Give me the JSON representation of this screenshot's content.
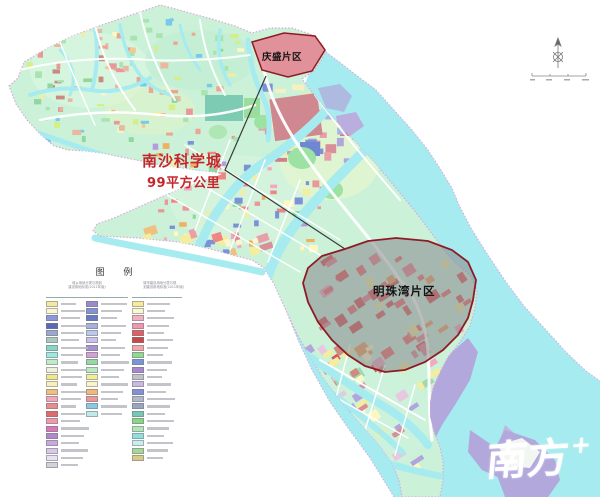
{
  "map": {
    "science_city": {
      "name": "南沙科学城",
      "area": "99平方公里"
    },
    "regions": {
      "qingsheng": {
        "name": "庆盛片区"
      },
      "mingzhuwan": {
        "name": "明珠湾片区"
      }
    },
    "watermark": {
      "text": "南方",
      "plus": "+"
    }
  },
  "legend": {
    "title": "图 例",
    "group_headers": [
      {
        "line1": "城乡用地分类与规划",
        "line2": "建设用地标准(2011年版)"
      },
      {
        "line1": "城市建设用地分类与规",
        "line2": "划建设用地标准(2011年版)"
      }
    ],
    "columns": [
      {
        "swatches": [
          "#f2e9a4",
          "#fbf6d2",
          "#8b98d8",
          "#5a68b8",
          "#9aa8cc",
          "#aac8bc",
          "#84d6c6",
          "#9fe8e0",
          "#bfecc6",
          "#eef0de",
          "#efe78e",
          "#f8f0bc",
          "#eec07e",
          "#f2a8ba",
          "#e88c8c",
          "#df6a6a",
          "#ef99a9",
          "#d878b8",
          "#b189ca",
          "#c9a9d9",
          "#d9c9e9",
          "#e9e1f1",
          "#d2d2da"
        ]
      },
      {
        "swatches": [
          "#9a8aca",
          "#8292d2",
          "#6a7ac2",
          "#a2b2da",
          "#bac9e9",
          "#c9c1e9",
          "#a991d1",
          "#d1a1d1",
          "#92d9a2",
          "#bae9c2",
          "#f1ed9a",
          "#f9f5c9",
          "#f1b979",
          "#e99999",
          "#8ac9e1",
          "#c1e9e9"
        ]
      },
      {
        "swatches": [
          "#f4ec9c",
          "#fcf7cf",
          "#f1b1c1",
          "#ef97af",
          "#df6060",
          "#c74848",
          "#efa7a7",
          "#91d991",
          "#7997d7",
          "#a787cf",
          "#c1c1c9",
          "#c9b9df",
          "#8191d1",
          "#b1b9c9",
          "#97a7bf",
          "#77c7b7",
          "#87d787",
          "#afe7b7",
          "#8fdfdf",
          "#c7efeb",
          "#a7d797",
          "#d7cb87"
        ]
      }
    ]
  },
  "colors": {
    "page-bg": "#ffffff",
    "water": "#a6ebef",
    "land": "#cbf1d9",
    "coast": "#dda8d8",
    "label-red": "#c4272b",
    "boundary-dark": "#3a3a3a",
    "region-border": "#8e1b24",
    "qingsheng-fill": "#e5808d",
    "overlay-gray": "#87878b",
    "road": "#ffffff",
    "port-lavender": "#b2a8dc",
    "watermark": "#ffffff"
  }
}
